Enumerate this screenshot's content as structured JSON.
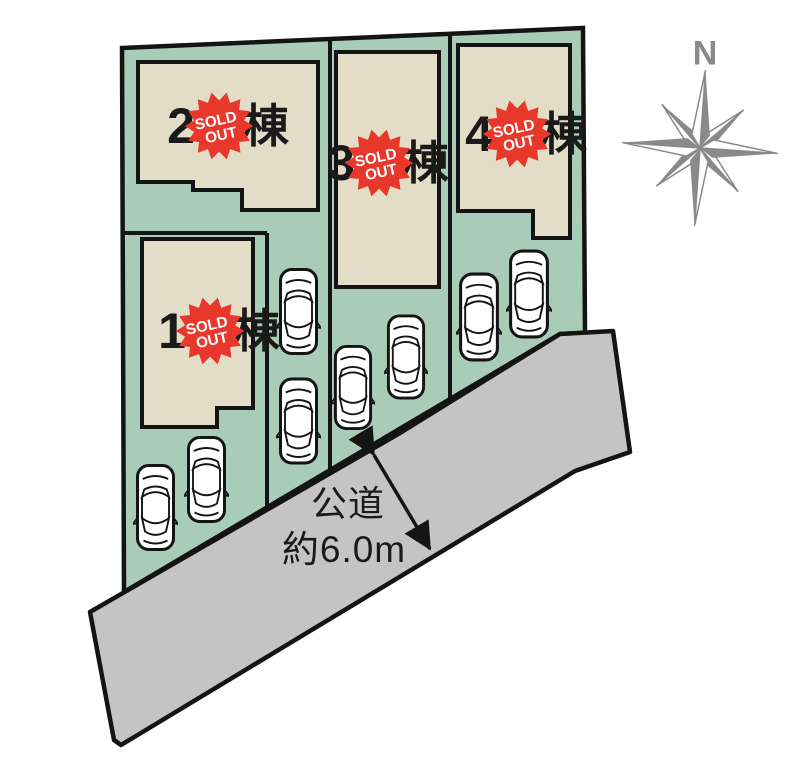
{
  "compass": {
    "label": "N"
  },
  "road": {
    "name_label": "公道",
    "width_label": "約6.0m"
  },
  "badge": {
    "line1": "SOLD",
    "line2": "OUT"
  },
  "lots": [
    {
      "number": "1",
      "suffix": "棟",
      "status": "SOLD OUT"
    },
    {
      "number": "2",
      "suffix": "棟",
      "status": "SOLD OUT"
    },
    {
      "number": "3",
      "suffix": "棟",
      "status": "SOLD OUT"
    },
    {
      "number": "4",
      "suffix": "棟",
      "status": "SOLD OUT"
    }
  ],
  "colors": {
    "lot_green": "#a8ccb7",
    "building_beige": "#e3dcc7",
    "road_gray": "#c4c4c4",
    "badge_red": "#e8372b",
    "compass_gray": "#8a8a8a",
    "outline_black": "#141414"
  }
}
